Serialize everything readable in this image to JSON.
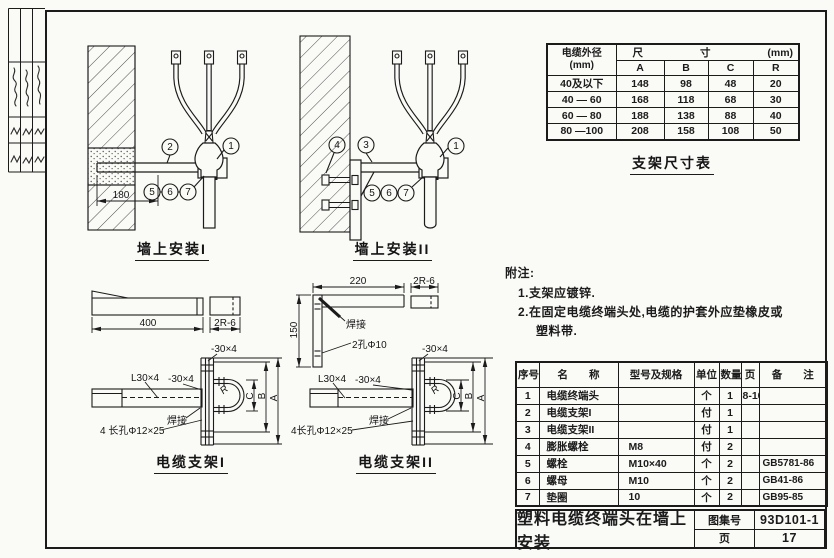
{
  "title_block": {
    "title": "塑料电缆终端头在墙上安装",
    "atlas_label": "图集号",
    "atlas_no": "93D101-1",
    "page_label": "页",
    "page_no": "17"
  },
  "dim_table": {
    "caption": "支架尺寸表",
    "header_diameter_line1": "电缆外径",
    "header_diameter_line2": "(mm)",
    "size_left": "尺",
    "size_right": "寸",
    "size_unit": "(mm)",
    "columns": [
      "A",
      "B",
      "C",
      "R"
    ],
    "rows": [
      {
        "d": "40及以下",
        "a": "148",
        "b": "98",
        "c": "48",
        "r": "20"
      },
      {
        "d": "40 — 60",
        "a": "168",
        "b": "118",
        "c": "68",
        "r": "30"
      },
      {
        "d": "60 — 80",
        "a": "188",
        "b": "138",
        "c": "88",
        "r": "40"
      },
      {
        "d": "80 —100",
        "a": "208",
        "b": "158",
        "c": "108",
        "r": "50"
      }
    ]
  },
  "notes": {
    "heading": "附注:",
    "lines": [
      "1.支架应镀锌.",
      "2.在固定电缆终端头处,电缆的护套外应垫橡皮或",
      "塑料带."
    ]
  },
  "parts_table": {
    "headers": {
      "no": "序号",
      "name": "名　　称",
      "spec": "型号及规格",
      "unit": "单位",
      "qty": "数量",
      "page": "页",
      "note": "备　　注"
    },
    "rows": [
      {
        "no": "1",
        "name": "电缆终端头",
        "spec": "",
        "unit": "个",
        "qty": "1",
        "page": "8-10",
        "note": ""
      },
      {
        "no": "2",
        "name": "电缆支架I",
        "spec": "",
        "unit": "付",
        "qty": "1",
        "page": "",
        "note": ""
      },
      {
        "no": "3",
        "name": "电缆支架II",
        "spec": "",
        "unit": "付",
        "qty": "1",
        "page": "",
        "note": ""
      },
      {
        "no": "4",
        "name": "膨胀螺栓",
        "spec": "M8",
        "unit": "付",
        "qty": "2",
        "page": "",
        "note": ""
      },
      {
        "no": "5",
        "name": "螺栓",
        "spec": "M10×40",
        "unit": "个",
        "qty": "2",
        "page": "",
        "note": "GB5781-86"
      },
      {
        "no": "6",
        "name": "螺母",
        "spec": "M10",
        "unit": "个",
        "qty": "2",
        "page": "",
        "note": "GB41-86"
      },
      {
        "no": "7",
        "name": "垫圈",
        "spec": "10",
        "unit": "个",
        "qty": "2",
        "page": "",
        "note": "GB95-85"
      }
    ]
  },
  "diagrams": {
    "wall1": {
      "caption": "墙上安装I",
      "embed_depth": "180",
      "c1": "1",
      "c2": "2",
      "c5": "5",
      "c6": "6",
      "c7": "7"
    },
    "wall2": {
      "caption": "墙上安装II",
      "c1": "1",
      "c3": "3",
      "c4": "4",
      "c5": "5",
      "c6": "6",
      "c7": "7"
    },
    "bk1": {
      "caption": "电缆支架I",
      "len": "400",
      "strip": "2R-6",
      "angle": "L30×4",
      "flat_top": "-30×4",
      "flat": "-30×4",
      "weld": "焊接",
      "holes": "4 长孔Φ12×25",
      "a": "A",
      "b": "B",
      "c": "C",
      "r": "R"
    },
    "bk2": {
      "caption": "电缆支架II",
      "len": "220",
      "strip": "2R-6",
      "height": "150",
      "weld_top": "焊接",
      "holes_top": "2孔Φ10",
      "angle": "L30×4",
      "flat_top": "-30×4",
      "flat": "-30×4",
      "weld": "焊接",
      "holes": "4长孔Φ12×25",
      "a": "A",
      "b": "B",
      "c": "C",
      "r": "R"
    }
  }
}
